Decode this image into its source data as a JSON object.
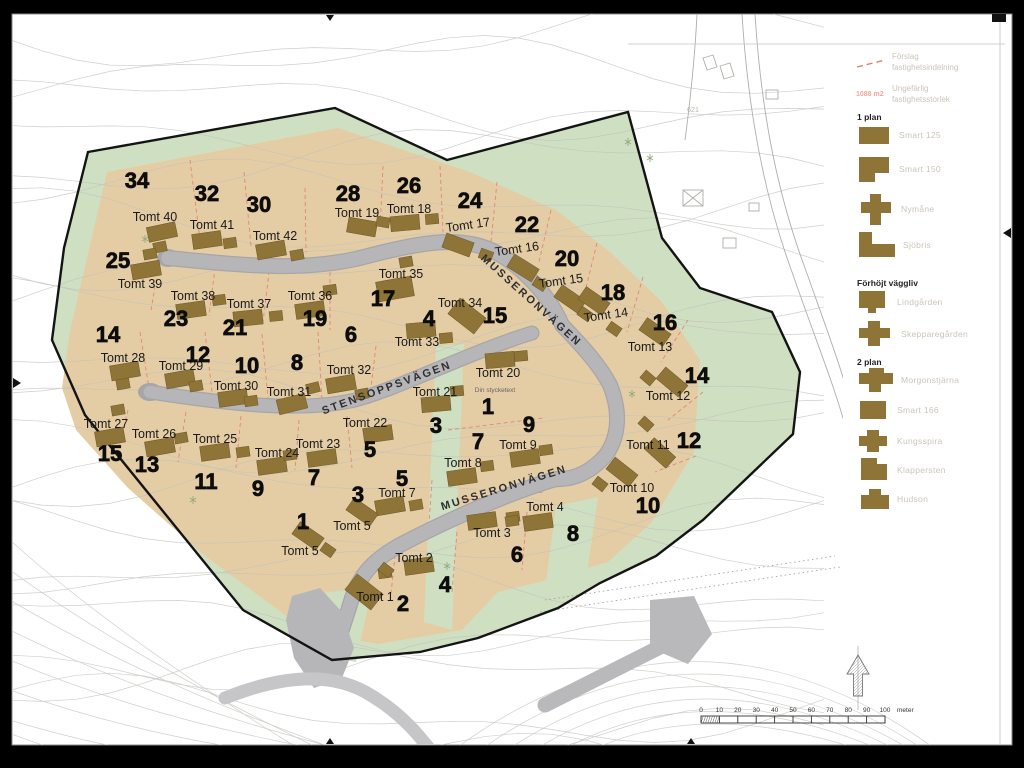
{
  "colors": {
    "site_green": "#cfe0c2",
    "plots_tan": "#e4cda4",
    "road_gray": "#b6b6b9",
    "road_edge": "#a6a6aa",
    "external_road": "#c6c6c9",
    "house_brown": "#8f7437",
    "house_outline": "#6e5628",
    "boundary_black": "#141414",
    "parcel_red": "#e4796e",
    "contour_gray": "#c2c2bd",
    "legend_text_gray": "#cbc5b9",
    "legend_red": "#efa79e",
    "label_dark": "#1a1a1a"
  },
  "legend": {
    "proposal": {
      "line1": "Förslag",
      "line2": "fastighetsindelning"
    },
    "size_note": {
      "value": "1088 m2",
      "line1": "Ungefärlig",
      "line2": "fastighetsstorlek"
    },
    "groups": [
      {
        "title": "1 plan",
        "items": [
          {
            "name": "Smart 125"
          },
          {
            "name": "Smart 150"
          },
          {
            "name": "Nymåne"
          },
          {
            "name": "Sjöbris"
          }
        ]
      },
      {
        "title": "Förhöjt väggliv",
        "items": [
          {
            "name": "Lindgården"
          },
          {
            "name": "Skepparegården"
          }
        ]
      },
      {
        "title": "2 plan",
        "items": [
          {
            "name": "Morgonstjärna"
          },
          {
            "name": "Smart 166"
          },
          {
            "name": "Kungsspira"
          },
          {
            "name": "Klappersten"
          },
          {
            "name": "Hudson"
          }
        ]
      }
    ]
  },
  "map": {
    "streets": [
      {
        "name": "MUSSERONVÄGEN",
        "x": 529,
        "y": 303,
        "rot": 42
      },
      {
        "name": "STENSOPPSVÄGEN",
        "x": 388,
        "y": 391,
        "rot": -20
      },
      {
        "name": "MUSSERONVÄGEN",
        "x": 505,
        "y": 491,
        "rot": -17
      }
    ],
    "note": {
      "text": "Din stycketext",
      "x": 495,
      "y": 392
    },
    "elevation_label": {
      "text": "621",
      "x": 693,
      "y": 112
    },
    "plot_numbers": [
      {
        "n": "34",
        "x": 137,
        "y": 180
      },
      {
        "n": "32",
        "x": 207,
        "y": 193
      },
      {
        "n": "30",
        "x": 259,
        "y": 204
      },
      {
        "n": "28",
        "x": 348,
        "y": 193
      },
      {
        "n": "26",
        "x": 409,
        "y": 185
      },
      {
        "n": "24",
        "x": 470,
        "y": 200
      },
      {
        "n": "22",
        "x": 527,
        "y": 224
      },
      {
        "n": "20",
        "x": 567,
        "y": 258
      },
      {
        "n": "18",
        "x": 613,
        "y": 292
      },
      {
        "n": "16",
        "x": 665,
        "y": 322
      },
      {
        "n": "25",
        "x": 118,
        "y": 260
      },
      {
        "n": "23",
        "x": 176,
        "y": 318
      },
      {
        "n": "21",
        "x": 235,
        "y": 327
      },
      {
        "n": "19",
        "x": 315,
        "y": 318
      },
      {
        "n": "17",
        "x": 383,
        "y": 298
      },
      {
        "n": "15",
        "x": 495,
        "y": 315
      },
      {
        "n": "14",
        "x": 108,
        "y": 334
      },
      {
        "n": "12",
        "x": 198,
        "y": 354
      },
      {
        "n": "10",
        "x": 247,
        "y": 365
      },
      {
        "n": "8",
        "x": 297,
        "y": 362
      },
      {
        "n": "6",
        "x": 351,
        "y": 334
      },
      {
        "n": "4",
        "x": 429,
        "y": 318
      },
      {
        "n": "14",
        "x": 697,
        "y": 375
      },
      {
        "n": "12",
        "x": 689,
        "y": 440
      },
      {
        "n": "15",
        "x": 110,
        "y": 453
      },
      {
        "n": "13",
        "x": 147,
        "y": 464
      },
      {
        "n": "11",
        "x": 206,
        "y": 481
      },
      {
        "n": "9",
        "x": 258,
        "y": 488
      },
      {
        "n": "7",
        "x": 314,
        "y": 477
      },
      {
        "n": "5",
        "x": 370,
        "y": 449
      },
      {
        "n": "3",
        "x": 436,
        "y": 425
      },
      {
        "n": "1",
        "x": 488,
        "y": 406
      },
      {
        "n": "9",
        "x": 529,
        "y": 424
      },
      {
        "n": "7",
        "x": 478,
        "y": 441
      },
      {
        "n": "5",
        "x": 402,
        "y": 478
      },
      {
        "n": "3",
        "x": 358,
        "y": 494
      },
      {
        "n": "1",
        "x": 303,
        "y": 521
      },
      {
        "n": "10",
        "x": 648,
        "y": 505
      },
      {
        "n": "2",
        "x": 403,
        "y": 603
      },
      {
        "n": "4",
        "x": 445,
        "y": 584
      },
      {
        "n": "6",
        "x": 517,
        "y": 554
      },
      {
        "n": "8",
        "x": 573,
        "y": 533
      }
    ],
    "houses": [
      {
        "label": "Tomt 40",
        "lx": 155,
        "ly": 217,
        "hx": 162,
        "hy": 232,
        "hr": -12,
        "gx": 160,
        "gy": 247
      },
      {
        "label": "Tomt 41",
        "lx": 212,
        "ly": 225,
        "hx": 207,
        "hy": 240,
        "hr": -8,
        "gx": 230,
        "gy": 243
      },
      {
        "label": "Tomt 42",
        "lx": 275,
        "ly": 236,
        "hx": 271,
        "hy": 250,
        "hr": -10,
        "gx": 297,
        "gy": 255
      },
      {
        "label": "Tomt 39",
        "lx": 140,
        "ly": 284,
        "hx": 146,
        "hy": 270,
        "hr": -10,
        "gx": 150,
        "gy": 254
      },
      {
        "label": "Tomt 38",
        "lx": 193,
        "ly": 296,
        "hx": 191,
        "hy": 310,
        "hr": -8,
        "gx": 219,
        "gy": 300
      },
      {
        "label": "Tomt 37",
        "lx": 249,
        "ly": 304,
        "hx": 248,
        "hy": 318,
        "hr": -6,
        "gx": 276,
        "gy": 316
      },
      {
        "label": "Tomt 36",
        "lx": 310,
        "ly": 296,
        "hx": 310,
        "hy": 310,
        "hr": -8,
        "gx": 330,
        "gy": 290
      },
      {
        "label": "Tomt 35",
        "lx": 401,
        "ly": 274,
        "hx": 395,
        "hy": 289,
        "hr": -10,
        "hw": 36,
        "hh": 20,
        "gx": 406,
        "gy": 262
      },
      {
        "label": "Tomt 34",
        "lx": 460,
        "ly": 303,
        "hx": 467,
        "hy": 316,
        "hr": 38,
        "hw": 33,
        "hh": 20
      },
      {
        "label": "Tomt 33",
        "lx": 417,
        "ly": 342,
        "hx": 421,
        "hy": 330,
        "hr": -5,
        "gx": 446,
        "gy": 338
      },
      {
        "label": "Tomt 32",
        "lx": 349,
        "ly": 370,
        "hx": 341,
        "hy": 384,
        "hr": -10,
        "gx": 362,
        "gy": 394
      },
      {
        "label": "Tomt 28",
        "lx": 123,
        "ly": 358,
        "hx": 125,
        "hy": 371,
        "hr": -10,
        "gx": 123,
        "gy": 384
      },
      {
        "label": "Tomt 29",
        "lx": 181,
        "ly": 366,
        "hx": 180,
        "hy": 379,
        "hr": -10,
        "gx": 196,
        "gy": 386
      },
      {
        "label": "Tomt 30",
        "lx": 236,
        "ly": 386,
        "hx": 233,
        "hy": 398,
        "hr": -8,
        "gx": 251,
        "gy": 401
      },
      {
        "label": "Tomt 31",
        "lx": 289,
        "ly": 392,
        "hx": 292,
        "hy": 404,
        "hr": -14,
        "gx": 313,
        "gy": 388
      },
      {
        "label": "Tomt 27",
        "lx": 106,
        "ly": 424,
        "hx": 110,
        "hy": 437,
        "hr": -10,
        "gx": 118,
        "gy": 410
      },
      {
        "label": "Tomt 26",
        "lx": 154,
        "ly": 434,
        "hx": 160,
        "hy": 447,
        "hr": -10,
        "gx": 181,
        "gy": 438
      },
      {
        "label": "Tomt 25",
        "lx": 215,
        "ly": 439,
        "hx": 215,
        "hy": 452,
        "hr": -8,
        "gx": 243,
        "gy": 452
      },
      {
        "label": "Tomt 24",
        "lx": 277,
        "ly": 453,
        "hx": 272,
        "hy": 466,
        "hr": -8,
        "gx": 290,
        "gy": 455
      },
      {
        "label": "Tomt 23",
        "lx": 318,
        "ly": 444,
        "hx": 322,
        "hy": 458,
        "hr": -8
      },
      {
        "label": "Tomt 22",
        "lx": 365,
        "ly": 423,
        "hx": 378,
        "hy": 434,
        "hr": -8
      },
      {
        "label": "Tomt 21",
        "lx": 435,
        "ly": 392,
        "hx": 436,
        "hy": 404,
        "hr": -5,
        "gx": 457,
        "gy": 391
      },
      {
        "label": "Tomt 20",
        "lx": 498,
        "ly": 373,
        "hx": 500,
        "hy": 360,
        "hr": -5,
        "gx": 521,
        "gy": 356
      },
      {
        "label": "Tomt 19",
        "lx": 357,
        "ly": 213,
        "hx": 362,
        "hy": 227,
        "hr": 10,
        "gx": 383,
        "gy": 222
      },
      {
        "label": "Tomt 18",
        "lx": 409,
        "ly": 209,
        "hx": 405,
        "hy": 223,
        "hr": -5,
        "gx": 432,
        "gy": 219
      },
      {
        "label": "Tomt 17",
        "lx": 468,
        "ly": 225,
        "lrot": -8,
        "hx": 458,
        "hy": 245,
        "hr": 20,
        "gx": 486,
        "gy": 255
      },
      {
        "label": "Tomt 16",
        "lx": 517,
        "ly": 249,
        "lrot": -8,
        "hx": 523,
        "hy": 268,
        "hr": 32,
        "gx": 540,
        "gy": 284
      },
      {
        "label": "Tomt 15",
        "lx": 561,
        "ly": 281,
        "lrot": -8,
        "hx": 570,
        "hy": 299,
        "hr": 35,
        "gx": 585,
        "gy": 314
      },
      {
        "label": "Tomt 14",
        "lx": 606,
        "ly": 315,
        "lrot": -8,
        "hx": 594,
        "hy": 301,
        "hr": 35,
        "gx": 614,
        "gy": 329
      },
      {
        "label": "Tomt 13",
        "lx": 650,
        "ly": 347,
        "hx": 655,
        "hy": 332,
        "hr": 35
      },
      {
        "label": "Tomt 12",
        "lx": 668,
        "ly": 396,
        "hx": 672,
        "hy": 382,
        "hr": 40,
        "gx": 648,
        "gy": 378
      },
      {
        "label": "Tomt 11",
        "lx": 648,
        "ly": 445,
        "hx": 660,
        "hy": 453,
        "hr": 42,
        "gx": 646,
        "gy": 424
      },
      {
        "label": "Tomt 10",
        "lx": 632,
        "ly": 488,
        "hx": 622,
        "hy": 472,
        "hr": 38,
        "gx": 600,
        "gy": 484
      },
      {
        "label": "Tomt 9",
        "lx": 518,
        "ly": 445,
        "hx": 525,
        "hy": 458,
        "hr": -8,
        "gx": 546,
        "gy": 450
      },
      {
        "label": "Tomt 8",
        "lx": 463,
        "ly": 463,
        "hx": 462,
        "hy": 477,
        "hr": -8,
        "gx": 487,
        "gy": 466
      },
      {
        "label": "Tomt 7",
        "lx": 397,
        "ly": 493,
        "hx": 390,
        "hy": 506,
        "hr": -10,
        "gx": 416,
        "gy": 505
      },
      {
        "label": "Tomt 5",
        "lx": 352,
        "ly": 526,
        "hx": 362,
        "hy": 512,
        "hr": 35
      },
      {
        "label": "Tomt 5",
        "lx": 300,
        "ly": 551,
        "hx": 308,
        "hy": 536,
        "hr": 35,
        "gx": 328,
        "gy": 550
      },
      {
        "label": "Tomt 3",
        "lx": 492,
        "ly": 533,
        "hx": 482,
        "hy": 521,
        "hr": -8,
        "gx": 513,
        "gy": 517
      },
      {
        "label": "Tomt 4",
        "lx": 545,
        "ly": 507,
        "hx": 538,
        "hy": 522,
        "hr": -8,
        "gx": 512,
        "gy": 521
      },
      {
        "label": "Tomt 2",
        "lx": 414,
        "ly": 558,
        "hx": 419,
        "hy": 566,
        "hr": -8,
        "gx": 385,
        "gy": 573
      },
      {
        "label": "Tomt 1",
        "lx": 375,
        "ly": 597,
        "hx": 364,
        "hy": 592,
        "hr": 38,
        "hw": 33,
        "hh": 20,
        "gx": 386,
        "gy": 570
      }
    ]
  },
  "scale_bar": {
    "ticks": [
      "0",
      "10",
      "20",
      "30",
      "40",
      "50",
      "60",
      "70",
      "80",
      "90",
      "100"
    ],
    "unit": "meter"
  }
}
